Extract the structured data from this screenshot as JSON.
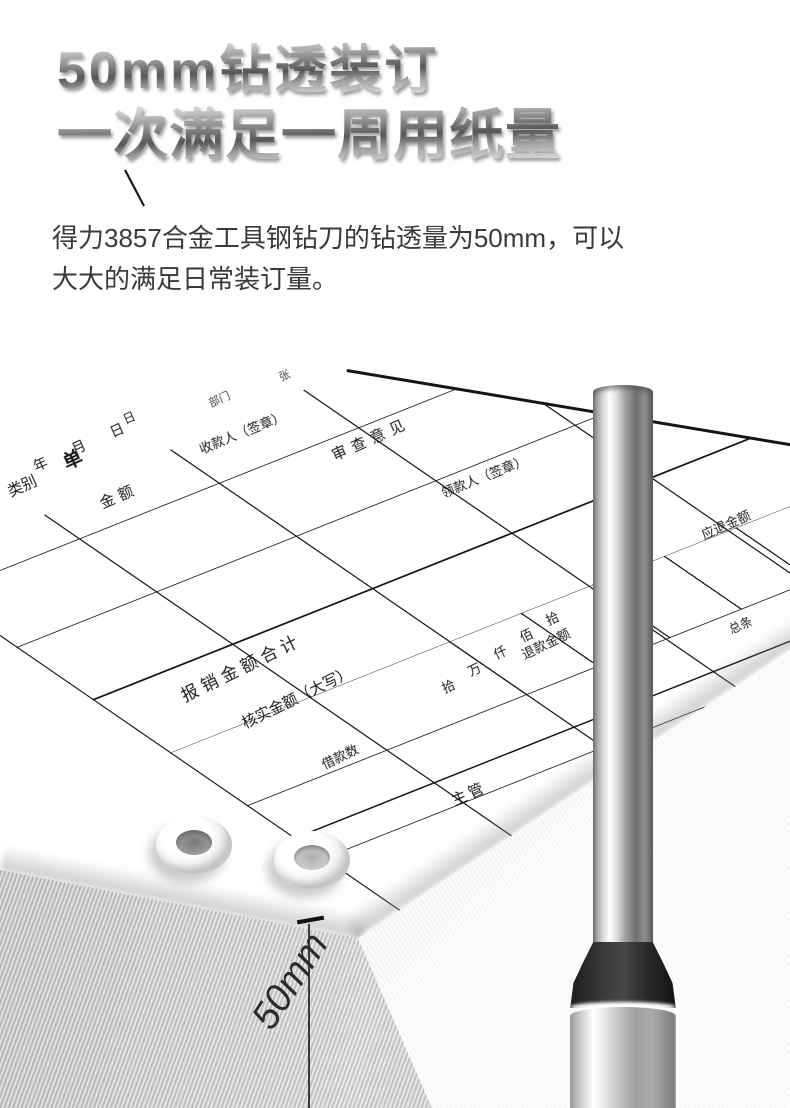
{
  "title": {
    "line1": "50mm钻透装订",
    "line2": "一次满足一周用纸量"
  },
  "description": {
    "line1": "得力3857合金工具钢钻刀的钻透量为50mm，可以",
    "line2": "大大的满足日常装订量。"
  },
  "dimension": {
    "label": "50mm"
  },
  "colors": {
    "metal_text_light": "#f1f1f1",
    "metal_text_dark": "#575757",
    "body_text": "#3a3a3a",
    "form_line": "#1a1a1a",
    "paper_side": "#c7c7c7"
  },
  "form": {
    "title_char": "单",
    "date_label": "年 月 日",
    "extra_day": "日",
    "dept_label": "部门",
    "sheet_label": "张",
    "category": "类别",
    "amount": "金额",
    "payer_sign": "收款人（签章）",
    "review": "审查意见",
    "payee_sign": "领款人（签章）",
    "total": "报销金额合计",
    "verified": "核实金额（大写）",
    "loan": "借款数",
    "refund": "退款金额",
    "refund_due": "应退金额",
    "digits": [
      "拾",
      "万",
      "仟",
      "佰",
      "拾"
    ],
    "manager": "主管",
    "count": "总条"
  }
}
